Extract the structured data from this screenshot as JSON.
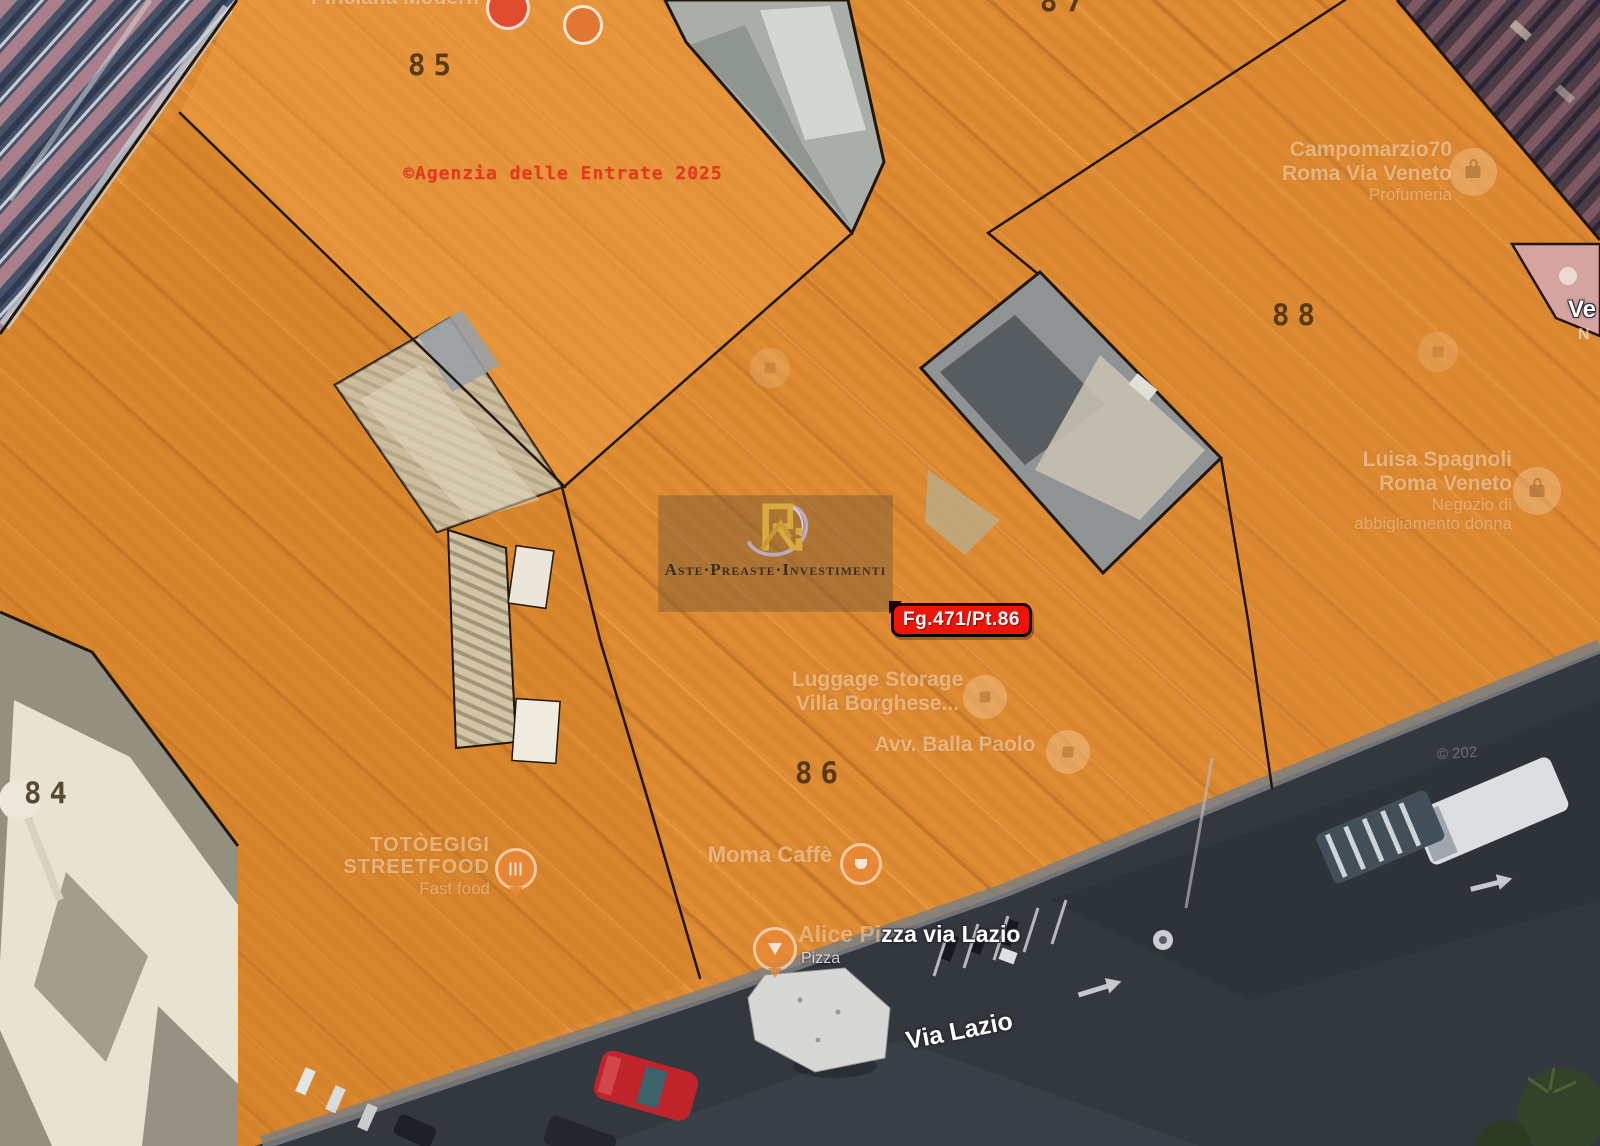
{
  "overlay": {
    "copyright": "©Agenzia delle Entrate 2025",
    "parcels": {
      "p84": "84",
      "p85": "85",
      "p86": "86",
      "p87": "87",
      "p88": "88"
    },
    "marker_badge": "Fg.471/Pt.86"
  },
  "watermark": {
    "brand": "Aste·Preaste·Investimenti"
  },
  "street": {
    "name": "Via Lazio",
    "imagery_credit": "© 202"
  },
  "pois": {
    "pinciana": {
      "name": "Pinciana Modern"
    },
    "campomarzio": {
      "line1": "Campomarzio70",
      "line2": "Roma Via Veneto",
      "category": "Profumeria"
    },
    "luisa": {
      "line1": "Luisa Spagnoli",
      "line2": "Roma Veneto",
      "category1": "Negozio di",
      "category2": "abbigliamento donna"
    },
    "luggage": {
      "line1": "Luggage Storage",
      "line2": "Villa Borghese..."
    },
    "avvocato": {
      "name": "Avv. Balla Paolo"
    },
    "moma": {
      "name": "Moma Caffè"
    },
    "toto": {
      "line1": "TOTÒEGIGI",
      "line2": "STREETFOOD",
      "category": "Fast food"
    },
    "alice": {
      "part_faint": "Alice Pi",
      "part_bright": "zza via Lazio",
      "category": "Pizza"
    },
    "veneto_edge": {
      "line1": "Ve",
      "line2": "N"
    }
  },
  "colors": {
    "overlay_orange": "#E08C33",
    "boundary_black": "#20160A",
    "badge_red": "#EE1408",
    "copyright_red": "#E8391F",
    "watermark_gold": "#D8AB3F",
    "street_asphalt": "#33383F"
  }
}
